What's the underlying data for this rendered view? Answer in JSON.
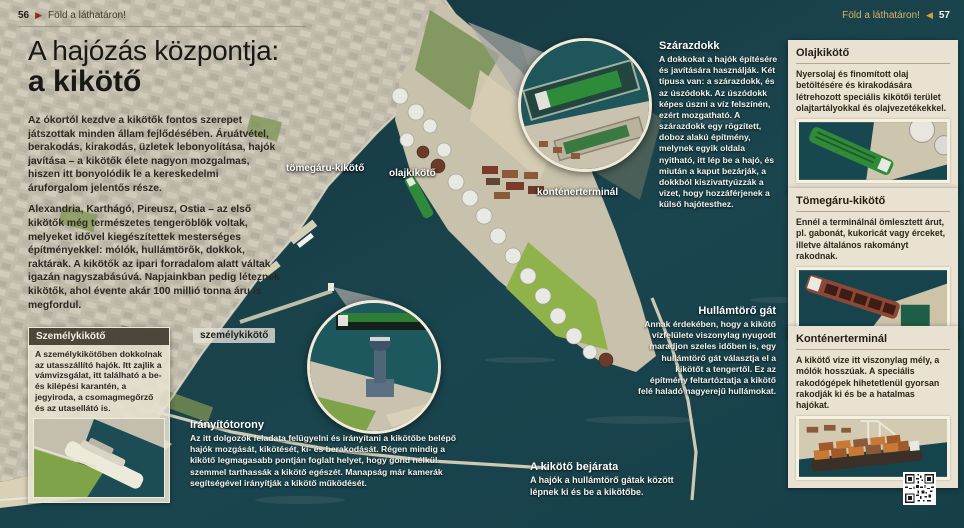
{
  "header": {
    "left": {
      "page": "56",
      "arrow": "▶",
      "label": "Föld a láthatáron!"
    },
    "right": {
      "label": "Föld a láthatáron!",
      "arrow": "◀",
      "page": "57"
    }
  },
  "title": {
    "line1": "A hajózás központja:",
    "line2": "a kikötő"
  },
  "intro": {
    "p1": "Az ókortól kezdve a kikötők fontos szerepet játszottak minden állam fejlődésében. Áruátvétel, berakodás, kirakodás, üzletek lebonyolítása, hajók javítása – a kikötők élete nagyon mozgalmas, hiszen itt bonyolódik le a kereskedelmi áruforgalom jelentős része.",
    "p2": "Alexandria, Karthágó, Pireusz, Ostia – az első kikötők még természetes tengeröblök voltak, melyeket idővel kiegészítettek mesterséges építményekkel: mólók, hullámtörők, dokkok, raktárak. A kikötők az ipari forradalom alatt váltak igazán nagyszabásúvá. Napjainkban pedig léteznek kikötők, ahol évente akár 100 millió tonna áru is megfordul."
  },
  "map_labels": {
    "bulk": "tömegáru-kikötő",
    "oil": "olajkikötő",
    "container": "konténerterminál",
    "passenger": "személykikötő"
  },
  "annotations": {
    "szarazdokk": {
      "title": "Szárazdokk",
      "body": "A dokkokat a hajók építésére és javítására használják. Két típusa van: a szárazdokk, és az úszódokk. Az úszódokk képes úszni a víz felszínén, ezért mozgatható. A szárazdokk egy rögzített, doboz alakú építmény, melynek egyik oldala nyitható, itt lép be a hajó, és miután a kaput bezárják, a dokkból kiszivattyúzzák a vizet, hogy hozzáférjenek a külső hajótesthez."
    },
    "hullamtoro": {
      "title": "Hullámtörő gát",
      "body": "Annak érdekében, hogy a kikötő vízfelülete viszonylag nyugodt maradjon szeles időben is, egy hullámtörő gát választja el a kikötőt a tengertől. Ez az építmény feltartóztatja a kikötő felé haladó nagyerejű hullámokat."
    },
    "iranyitotorony": {
      "title": "Irányítótorony",
      "body": "Az itt dolgozók feladata felügyelni és irányítani a kikötőbe belépő hajók mozgását, kikötését, ki- és berakodását. Régen mindig a kikötő legmagasabb pontján foglalt helyet, hogy gond nélkül szemmel tarthassák a kikötő egészét. Manapság már kamerák segítségével irányítják a kikötő működését."
    },
    "bejarat": {
      "title": "A kikötő bejárata",
      "body": "A hajók a hullámtörő gátak között lépnek ki és be a kikötőbe."
    },
    "szemelykikoto": {
      "title": "Személykikötő",
      "body": "A személykikötőben dokkolnak az utasszállító hajók. Itt zajlik a vámvizsgálat, itt található a be- és kilépési karantén, a jegyiroda, a csomagmegőrző és az utasellátó is."
    }
  },
  "sidebar": {
    "boxes": [
      {
        "title": "Olajkikötő",
        "body": "Nyersolaj és finomított olaj betöltésére és kirakodására létrehozott speciális kikötői terület olajtartályokkal és olajvezetékekkel."
      },
      {
        "title": "Tömegáru-kikötő",
        "body": "Ennél a terminálnál ömlesztett árut, pl. gabonát, kukoricát vagy érceket, illetve általános rakományt rakodnak."
      },
      {
        "title": "Konténerterminál",
        "body": "A kikötő vize itt viszonylag mély, a mólók hosszúak. A speciális rakodógépek hihetetlenül gyorsan rakodják ki és be a hatalmas hajókat."
      }
    ]
  },
  "colors": {
    "sea": "#1a454e",
    "land": "#c6c1b1",
    "card_cream": "#e9e2d2",
    "accent_red": "#8e2b20",
    "accent_orange": "#dfa957"
  }
}
